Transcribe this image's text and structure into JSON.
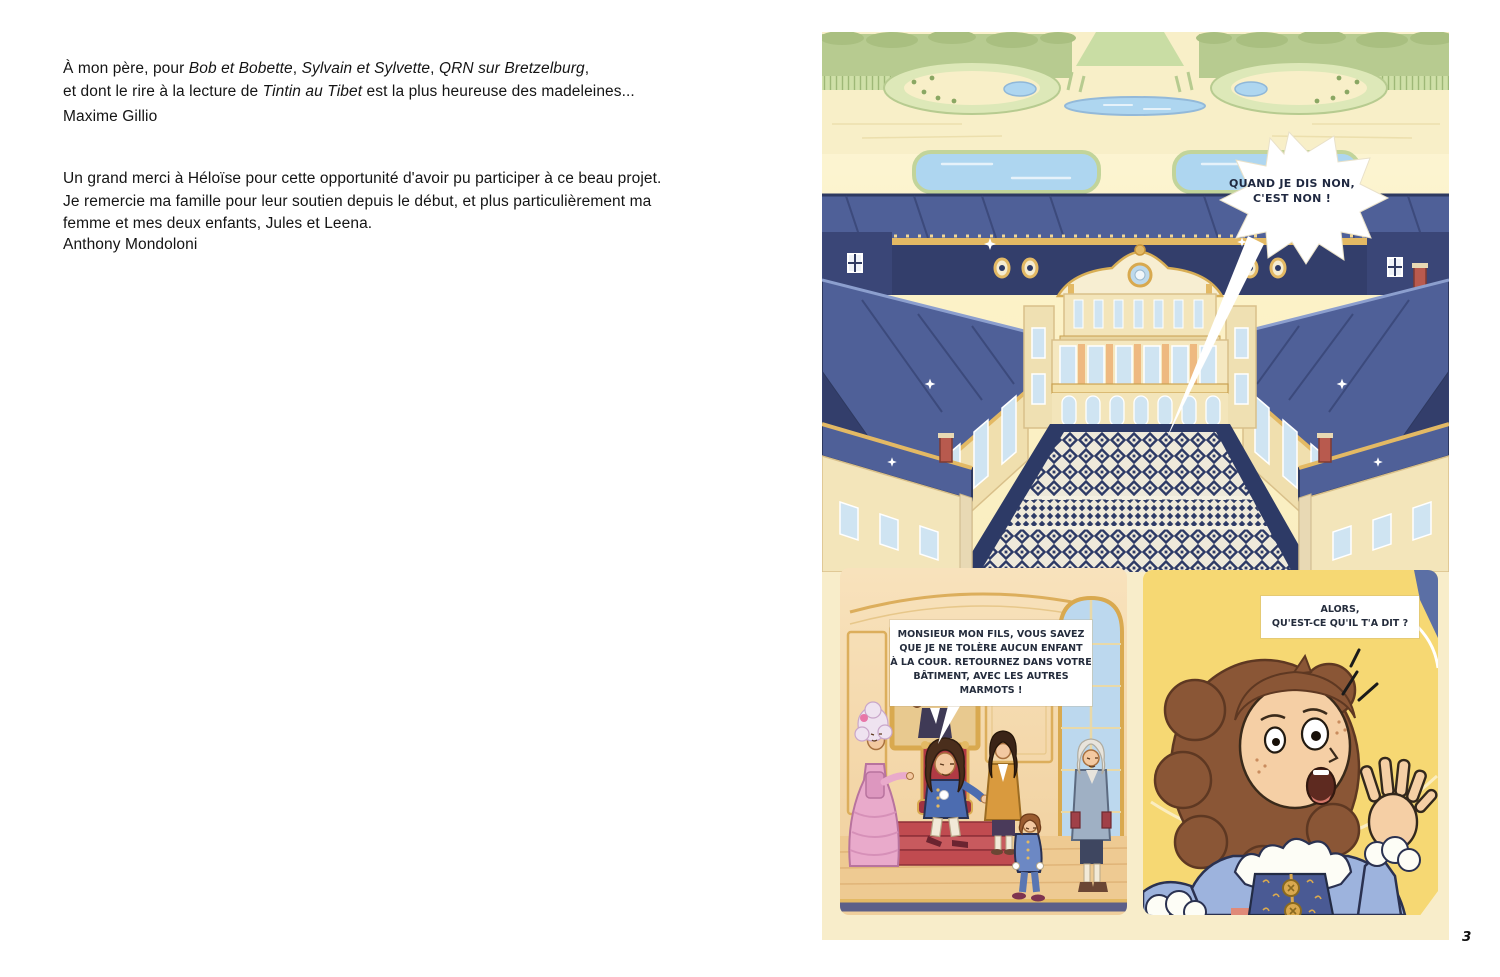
{
  "page_number": "3",
  "dedication": {
    "block1_line1": {
      "pre": "À mon père, pour ",
      "italic1": "Bob et Bobette",
      "sep1": ", ",
      "italic2": "Sylvain et Sylvette",
      "sep2": ", ",
      "italic3": "QRN sur Bretzelburg",
      "end": ","
    },
    "block1_line2": {
      "pre": "et dont le rire à la lecture de ",
      "italic": "Tintin au Tibet",
      "end": " est la plus heureuse des madeleines..."
    },
    "author1": "Maxime Gillio",
    "block2_line1": "Un grand merci à Héloïse pour cette opportunité d'avoir pu participer à ce beau projet.",
    "block2_line2": "Je remercie ma famille pour leur soutien depuis le début, et plus particulièrement ma",
    "block2_line3": "femme et mes deux enfants, Jules et Leena.",
    "author2": "Anthony Mondoloni"
  },
  "comic": {
    "bubbles": {
      "shout": "QUAND JE DIS NON,\nC'EST NON !",
      "king": "MONSIEUR MON FILS, VOUS SAVEZ\nQUE JE NE TOLÈRE AUCUN ENFANT\nÀ LA COUR. RETOURNEZ DANS VOTRE\nBÂTIMENT, AVEC LES AUTRES\nMARMOTS !",
      "friend": "ALORS,\nQU'EST-CE QU'IL T'A DIT ?"
    },
    "colors": {
      "page_cream": "#f8edca",
      "garden_green": "#b7cb90",
      "hedge_light": "#cfe0a8",
      "path_cream": "#f8efc8",
      "water_blue": "#aed6f0",
      "roof_dark": "#333e6b",
      "roof_mid": "#4f6098",
      "roof_light": "#8c9fce",
      "gold": "#e3b964",
      "facade_cream": "#f3e5ba",
      "courtyard_navy": "#2d3a66",
      "panel_yellow": "#f6d873",
      "throne_red": "#c04b50",
      "skin": "#f3c9a1",
      "hair_brown": "#8a5636",
      "dress_pink": "#e9aacb",
      "coat_blue": "#4c6cb0",
      "window_blue": "#cfe4f2",
      "throne_room_tan": "#f6dcae"
    }
  }
}
